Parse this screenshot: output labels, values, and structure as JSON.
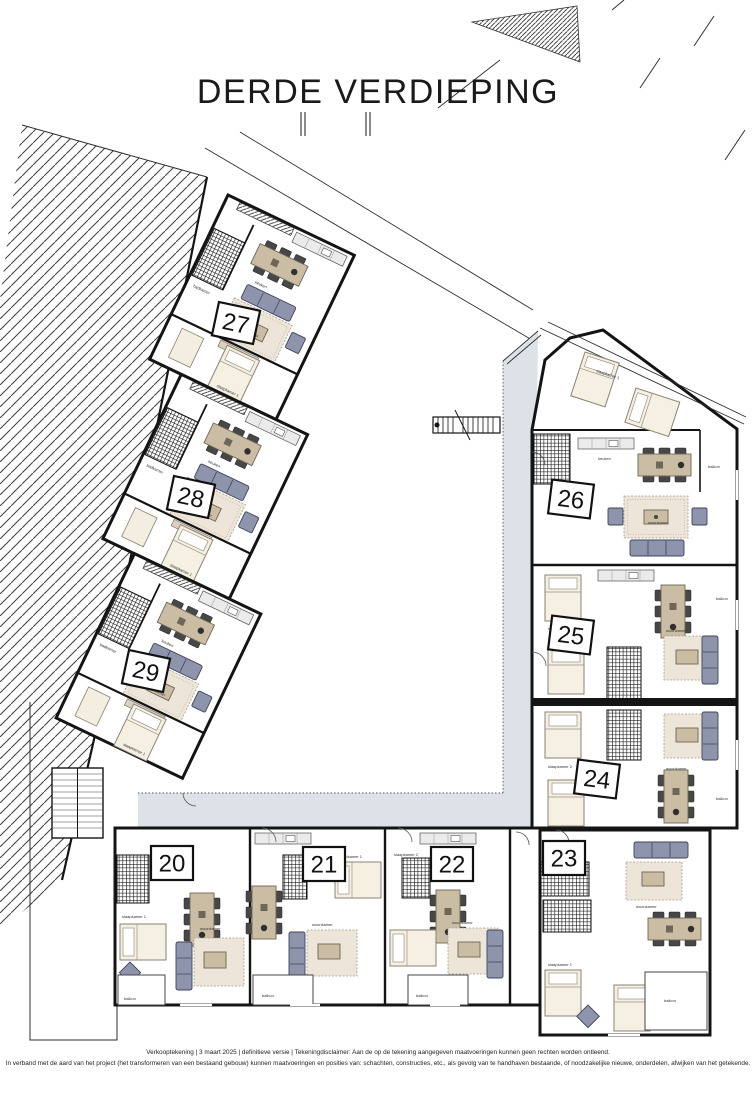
{
  "title": "DERDE VERDIEPING",
  "units": [
    {
      "label": "20"
    },
    {
      "label": "21"
    },
    {
      "label": "22"
    },
    {
      "label": "23"
    },
    {
      "label": "24"
    },
    {
      "label": "25"
    },
    {
      "label": "26"
    },
    {
      "label": "27"
    },
    {
      "label": "28"
    },
    {
      "label": "29"
    }
  ],
  "rooms": {
    "woonkamer": "woonkamer",
    "slaapkamer1": "slaapkamer 1",
    "slaapkamer2": "slaapkamer 2",
    "keuken": "keuken",
    "badkamer": "badkamer",
    "balkon": "balkon",
    "hal": "hal",
    "berging": "berging"
  },
  "footer": {
    "line1": "Verkooptekening   |   3 maart 2025   |   definitieve versie   |   Tekeningdisclaimer: Aan de op de tekening aangegeven maatvoeringen kunnen geen rechten worden ontleend.",
    "line2": "In verband met de aard van het project (het transformeren van een bestaand gebouw) kunnen maatvoeringen en posities van: schachten, constructies, etc., als gevolg van te handhaven bestaande, of noodzakelijke nieuwe, onderdelen, afwijken van het getekende."
  },
  "colors": {
    "wall_color": "#141414",
    "gallery_color": "#dce2e7",
    "sofa_color": "#8f94ad",
    "table_color": "#cbbda4",
    "rug_color": "#ece5d8",
    "bed_color": "#f6f0e3"
  }
}
